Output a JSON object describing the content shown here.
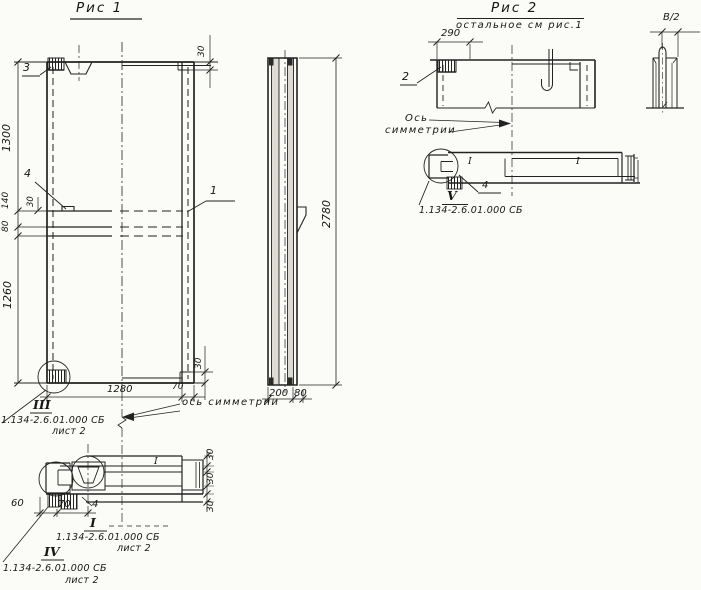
{
  "fig1": {
    "title": "Рис 1",
    "labels": {
      "item1": "1",
      "item3": "3",
      "item4": "4"
    },
    "dims": {
      "h1300": "1300",
      "h140": "140",
      "h30": "30",
      "h80": "80",
      "h1260": "1260",
      "top30": "30",
      "bottom30": "30",
      "bottom70": "70",
      "width1280": "1280"
    },
    "axis_note": "ось симметрии",
    "detail_iii": {
      "numeral": "III",
      "doc": "1.134-2.6.01.000 СБ",
      "sheet": "лист 2"
    }
  },
  "side_view": {
    "dims": {
      "h2780": "2780",
      "w200": "200",
      "w80": "80"
    }
  },
  "section_a": {
    "dims": {
      "d60": "60",
      "d70": "70",
      "r30a": "30",
      "r30b": "30",
      "r30c": "30"
    },
    "label_item4": "4",
    "pos_mark": "I",
    "detail_i": {
      "numeral": "I",
      "doc": "1.134-2.6.01.000 СБ",
      "sheet": "лист 2"
    },
    "detail_iv": {
      "numeral": "IV",
      "doc": "1.134-2.6.01.000 СБ",
      "sheet": "лист 2"
    }
  },
  "fig2": {
    "title": "Рис 2",
    "subtitle": "остальное см рис.1",
    "labels": {
      "item2": "2"
    },
    "dims": {
      "w290": "290",
      "b2": "В/2"
    },
    "axis_note_line1": "Ось",
    "axis_note_line2": "симметрии",
    "section": {
      "label_item4": "4",
      "pos_mark_a": "I",
      "pos_mark_b": "I",
      "detail_v": {
        "numeral": "V",
        "doc": "1.134-2.6.01.000 СБ"
      }
    }
  }
}
